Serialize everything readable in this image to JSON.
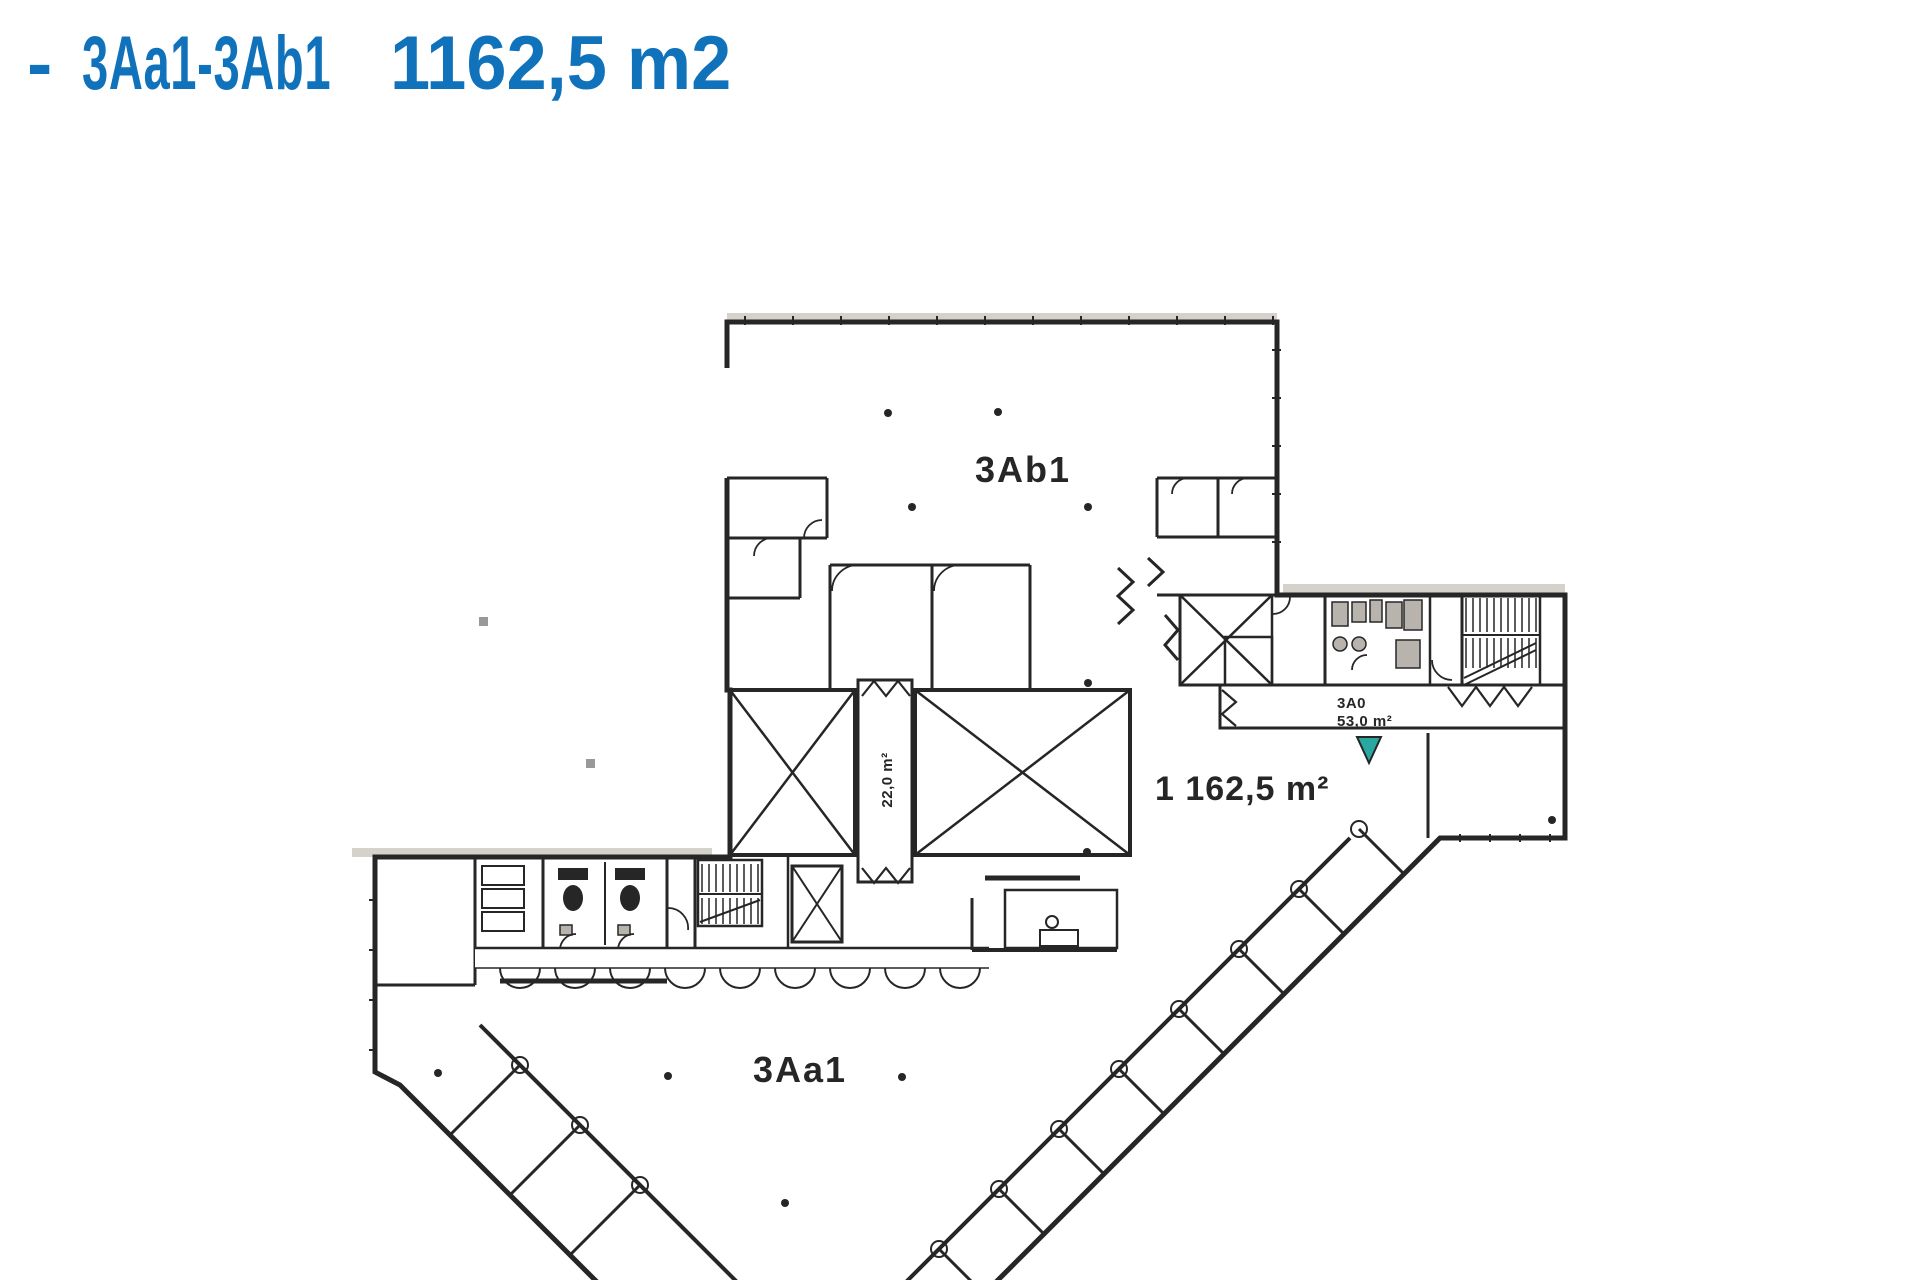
{
  "header": {
    "bullet": "-",
    "title": "3Aa1-3Ab1",
    "area": "1162,5 m2"
  },
  "floorplan": {
    "labels": {
      "unit_top": "3Ab1",
      "unit_bottom": "3Aa1",
      "total_area": "1 162,5 m²",
      "core_corridor_area": "22,0 m²",
      "right_corridor_name": "3A0",
      "right_corridor_area": "53,0 m²"
    }
  },
  "colors": {
    "header_text": "#1172bc",
    "unit_fill": "#e5695a",
    "corridor_fill": "#d5d2cb",
    "fixture_gray": "#b8b4ad",
    "outline": "#262626",
    "marker_teal": "#2aa7a0"
  }
}
